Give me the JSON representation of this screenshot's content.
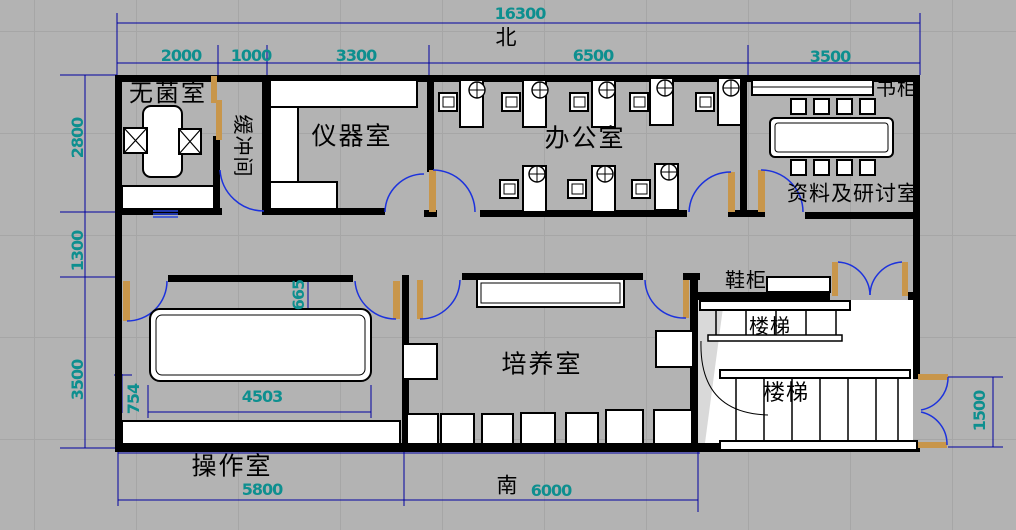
{
  "plan": {
    "title": "实验楼平面图",
    "north_label": "北",
    "south_label": "南",
    "rooms": [
      {
        "name": "sterile-room",
        "label": "无菌室"
      },
      {
        "name": "buffer-room",
        "label": "缓冲间"
      },
      {
        "name": "instrument-room",
        "label": "仪器室"
      },
      {
        "name": "office",
        "label": "办公室"
      },
      {
        "name": "archive-seminar-room",
        "label": "资料及研讨室"
      },
      {
        "name": "culture-room",
        "label": "培养室"
      },
      {
        "name": "operation-room",
        "label": "操作室"
      }
    ],
    "fixtures": [
      {
        "name": "bookcase",
        "label": "书柜"
      },
      {
        "name": "shoe-cabinet",
        "label": "鞋柜"
      },
      {
        "name": "stair-upper",
        "label": "楼梯"
      },
      {
        "name": "stair-lower",
        "label": "楼梯"
      }
    ],
    "dimensions": {
      "overall_width": "16300",
      "top_segments": [
        "2000",
        "1000",
        "3300",
        "6500",
        "3500"
      ],
      "left_segments": [
        "2800",
        "1300",
        "3500"
      ],
      "bottom_segments": [
        "5800",
        "6000"
      ],
      "right_entry": "1500",
      "op_table_width": "4503",
      "op_table_offset": "754",
      "corridor_offset": "665"
    },
    "colors": {
      "background": "#b3b3b3",
      "wall": "#000000",
      "dimension_line": "#0000a0",
      "dimension_text": "#0e8f8f",
      "door_arc": "#1c32dd",
      "door_leaf": "#c8964b",
      "furniture_fill": "#ffffff"
    }
  }
}
